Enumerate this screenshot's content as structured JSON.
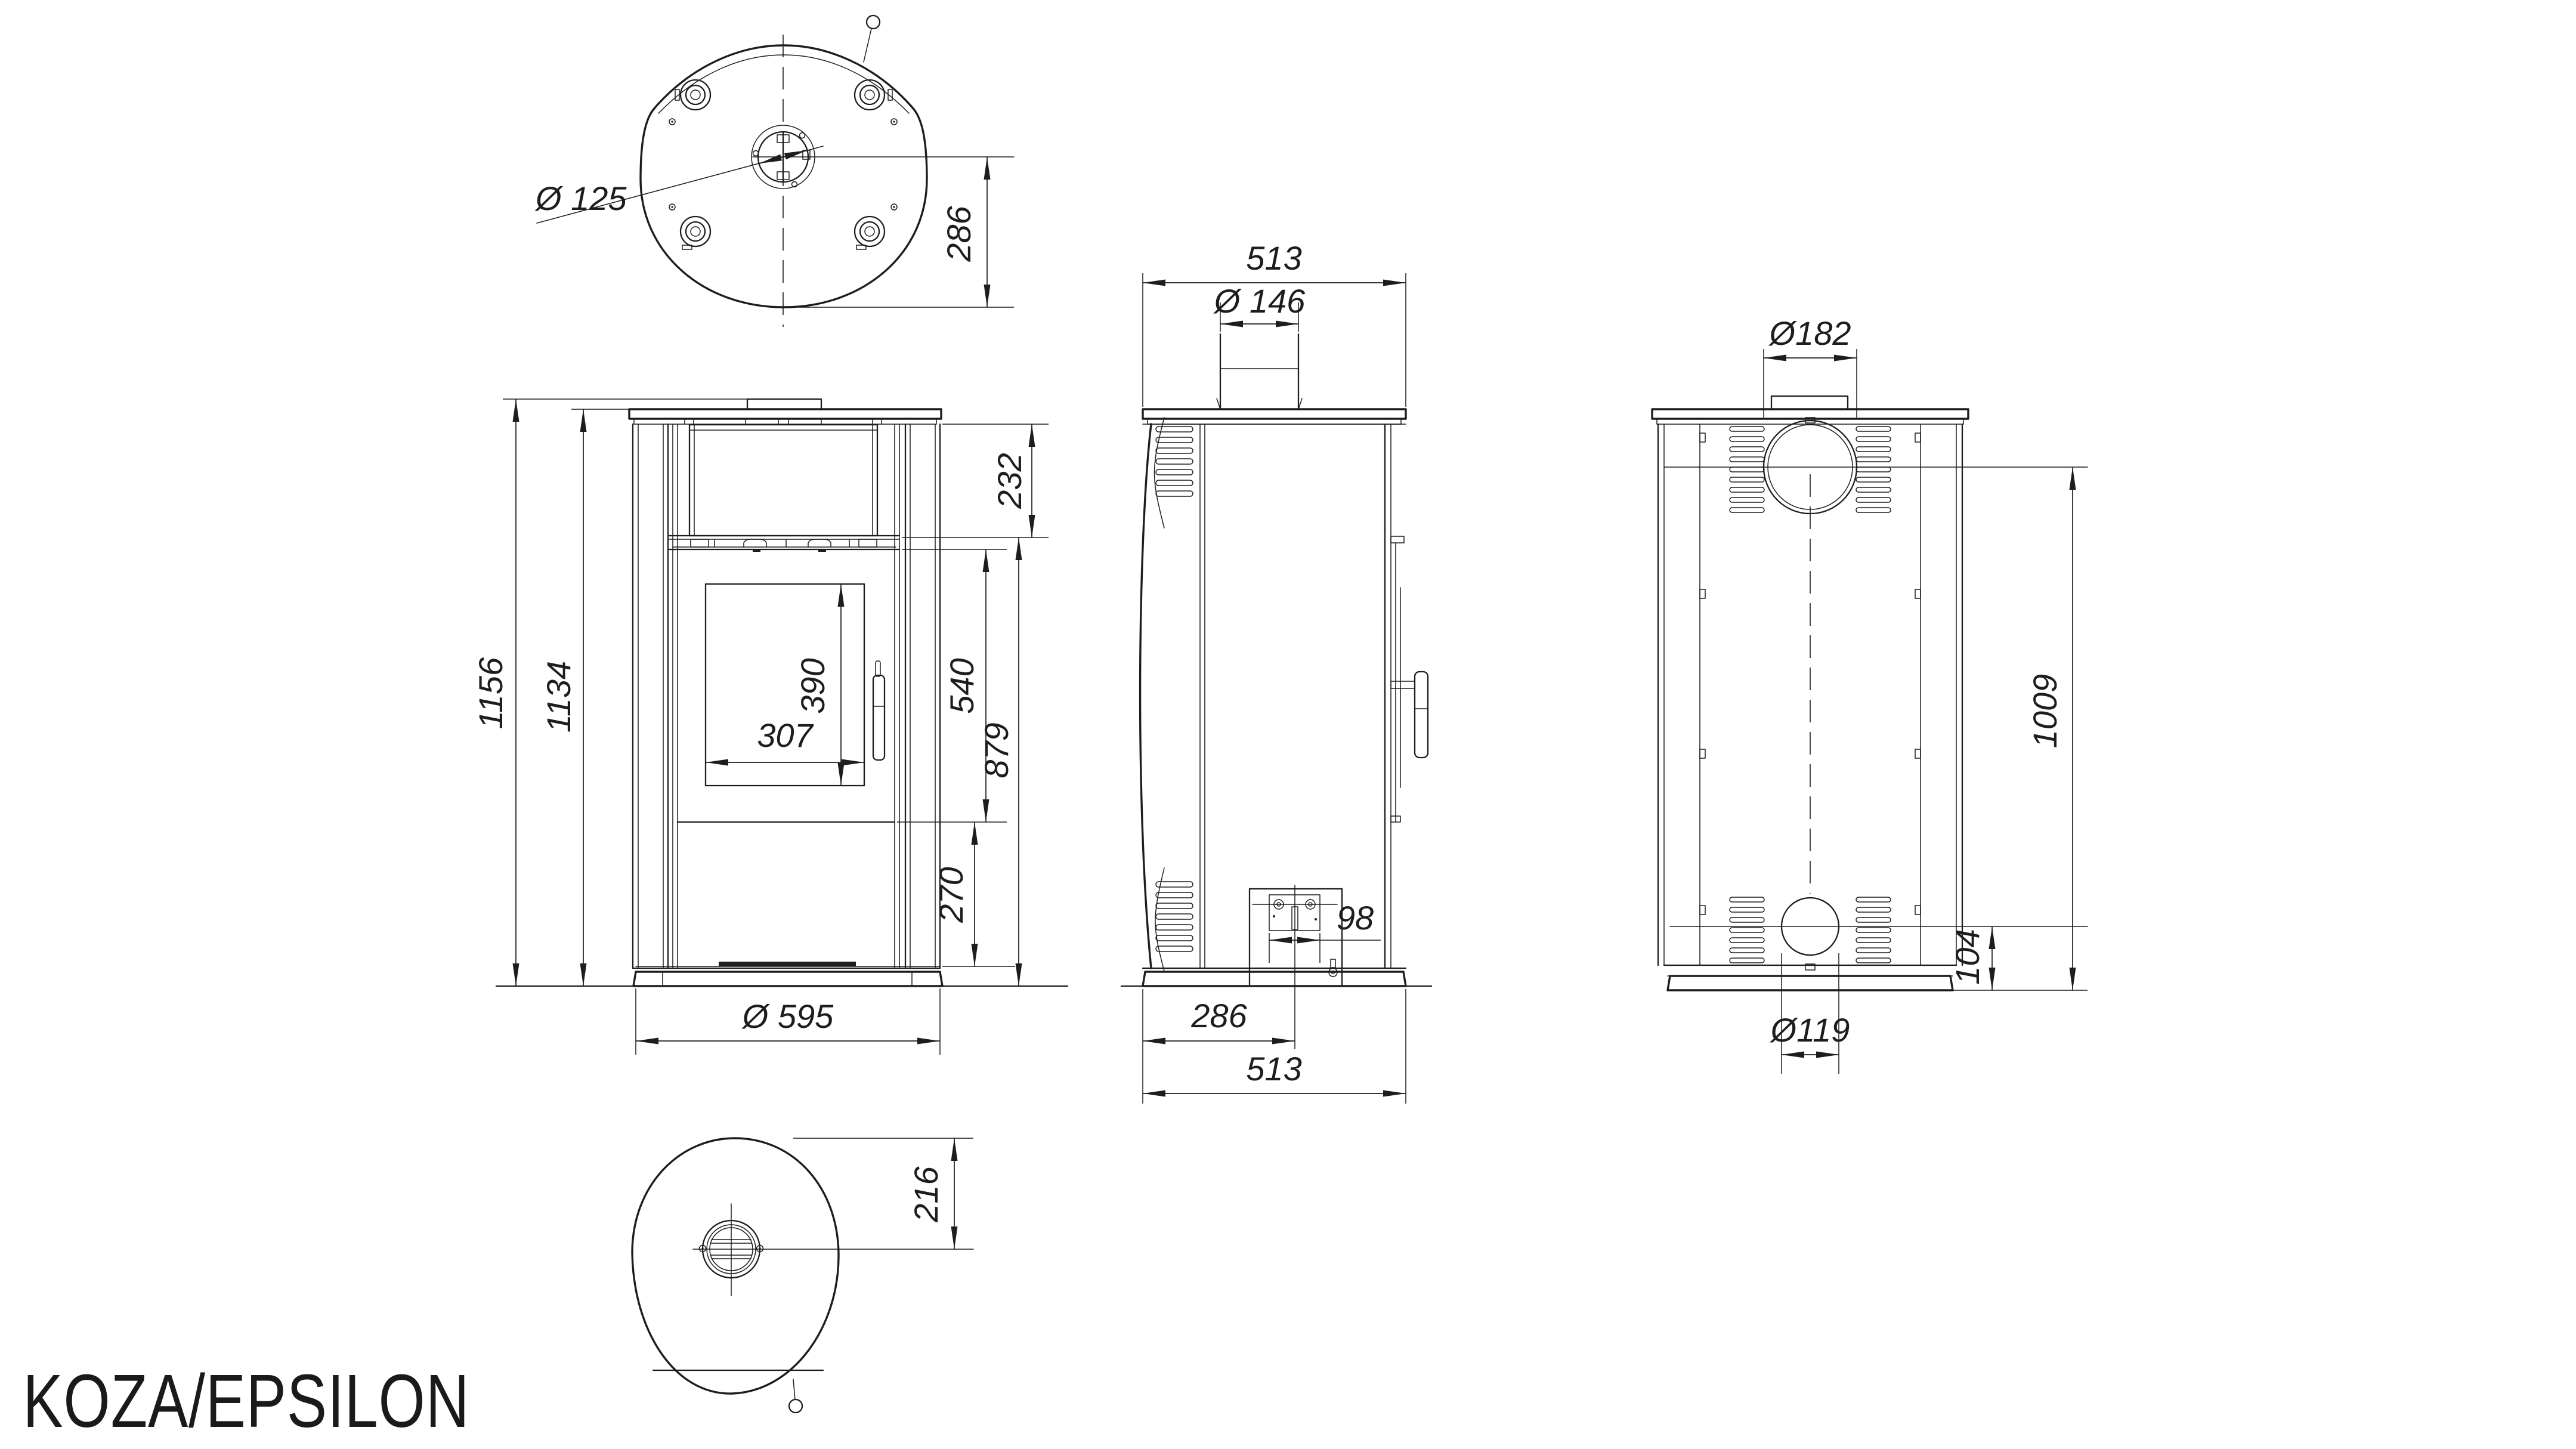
{
  "title": "KOZA/EPSILON",
  "colors": {
    "line": "#1d1d1b",
    "background": "#ffffff"
  },
  "views": {
    "top": {
      "dims": {
        "flue_diameter": "Ø 125",
        "flue_center_to_back": "286"
      }
    },
    "front": {
      "dims": {
        "overall_height": "1156",
        "body_height": "1134",
        "top_chamber_height": "232",
        "door_chamber_height": "540",
        "shelf_to_floor": "879",
        "glass_height": "390",
        "glass_width": "307",
        "lower_panel_height": "270",
        "base_diameter": "Ø 595"
      }
    },
    "side": {
      "dims": {
        "depth": "513",
        "flue_collar_diameter": "Ø 146",
        "ash_drawer_width": "98",
        "front_to_flue_axis": "286",
        "base_depth": "513"
      }
    },
    "back": {
      "dims": {
        "outlet_diameter": "Ø182",
        "outlet_axis_height": "1009",
        "inlet_axis_height": "104",
        "inlet_diameter": "Ø119"
      }
    },
    "bottom": {
      "dims": {
        "grate_center_offset": "216"
      }
    }
  }
}
